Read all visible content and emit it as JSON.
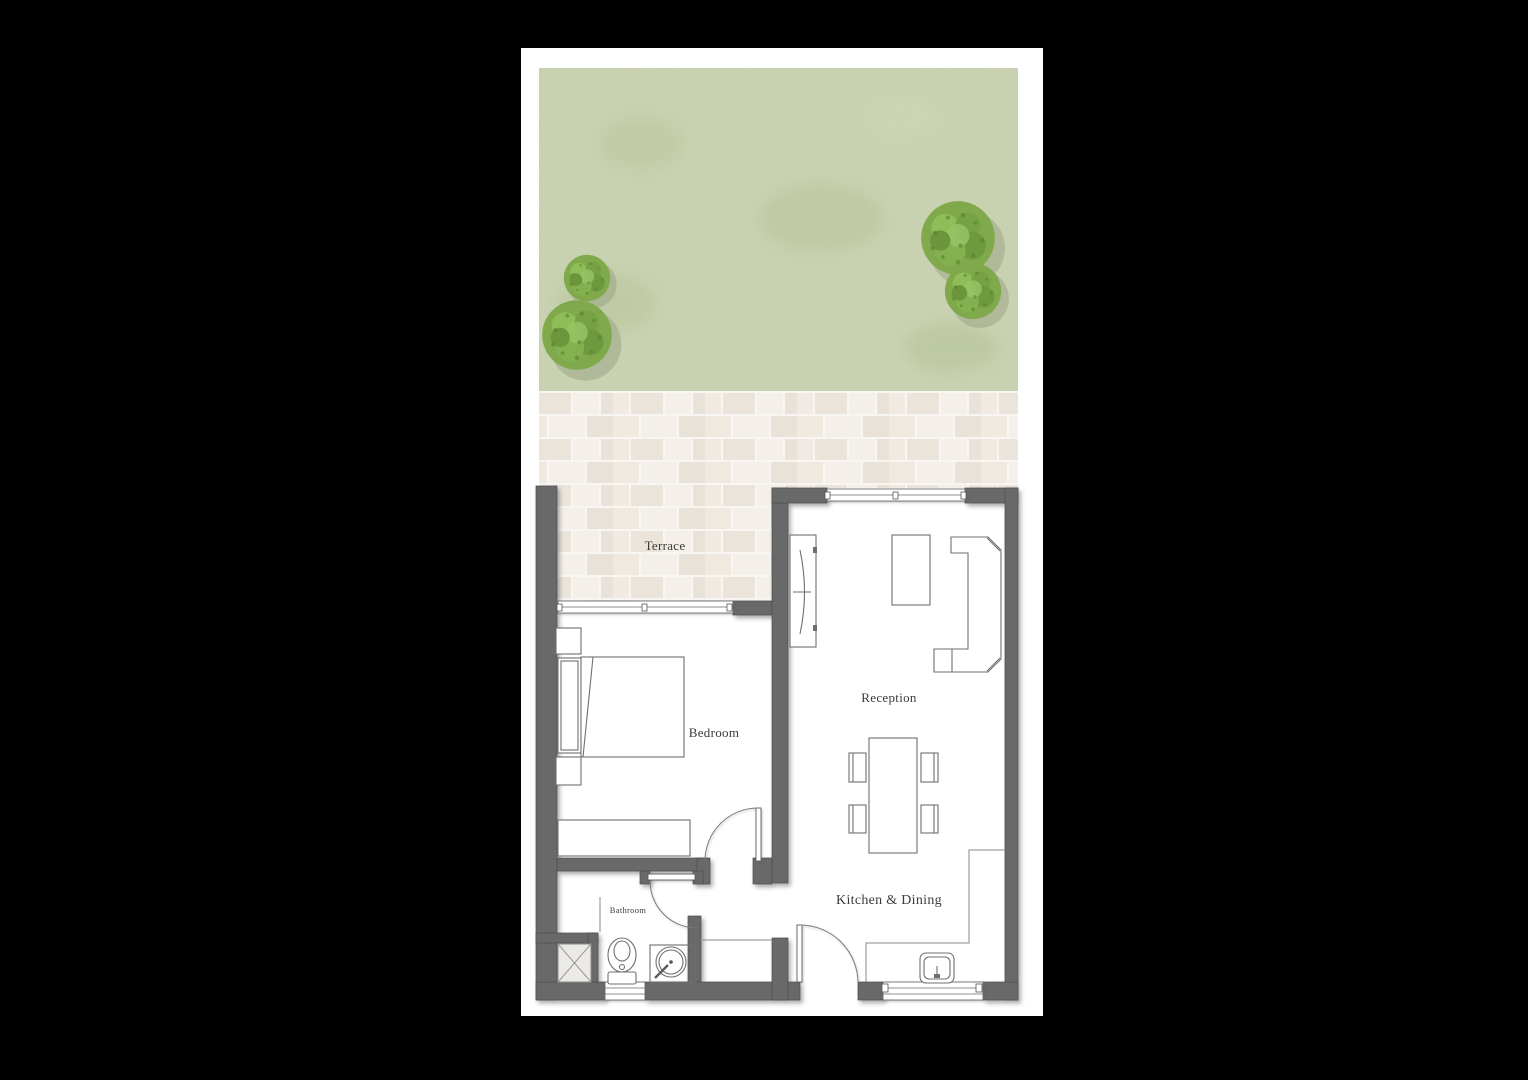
{
  "floorplan": {
    "title": "Apartment floor plan with garden",
    "rooms": {
      "terrace": {
        "label": "Terrace"
      },
      "bedroom": {
        "label": "Bedroom"
      },
      "reception": {
        "label": "Reception"
      },
      "kitchen_dining": {
        "label": "Kitchen & Dining"
      },
      "bathroom": {
        "label": "Bathroom"
      }
    },
    "elements": [
      "garden-lawn",
      "tree",
      "paving-tiles",
      "terrace-paving",
      "window",
      "door-swing",
      "bed",
      "headboard",
      "nightstand",
      "wardrobe-dresser",
      "tv-unit",
      "tv",
      "sofa-l-shaped",
      "coffee-table",
      "dining-table",
      "dining-chair",
      "kitchen-counter",
      "kitchen-sink",
      "shower",
      "toilet",
      "basin",
      "entrance-door"
    ],
    "colors": {
      "background": "#000000",
      "paper": "#ffffff",
      "wall": "#696969",
      "grass": "#c9d2b1",
      "tree": "#7fa94a",
      "tree_dark": "#55822f",
      "paving_light": "#f3ede5",
      "paving_dark": "#e6ded3",
      "line": "#6f6f6f",
      "label_text": "#3c3c3c"
    }
  }
}
